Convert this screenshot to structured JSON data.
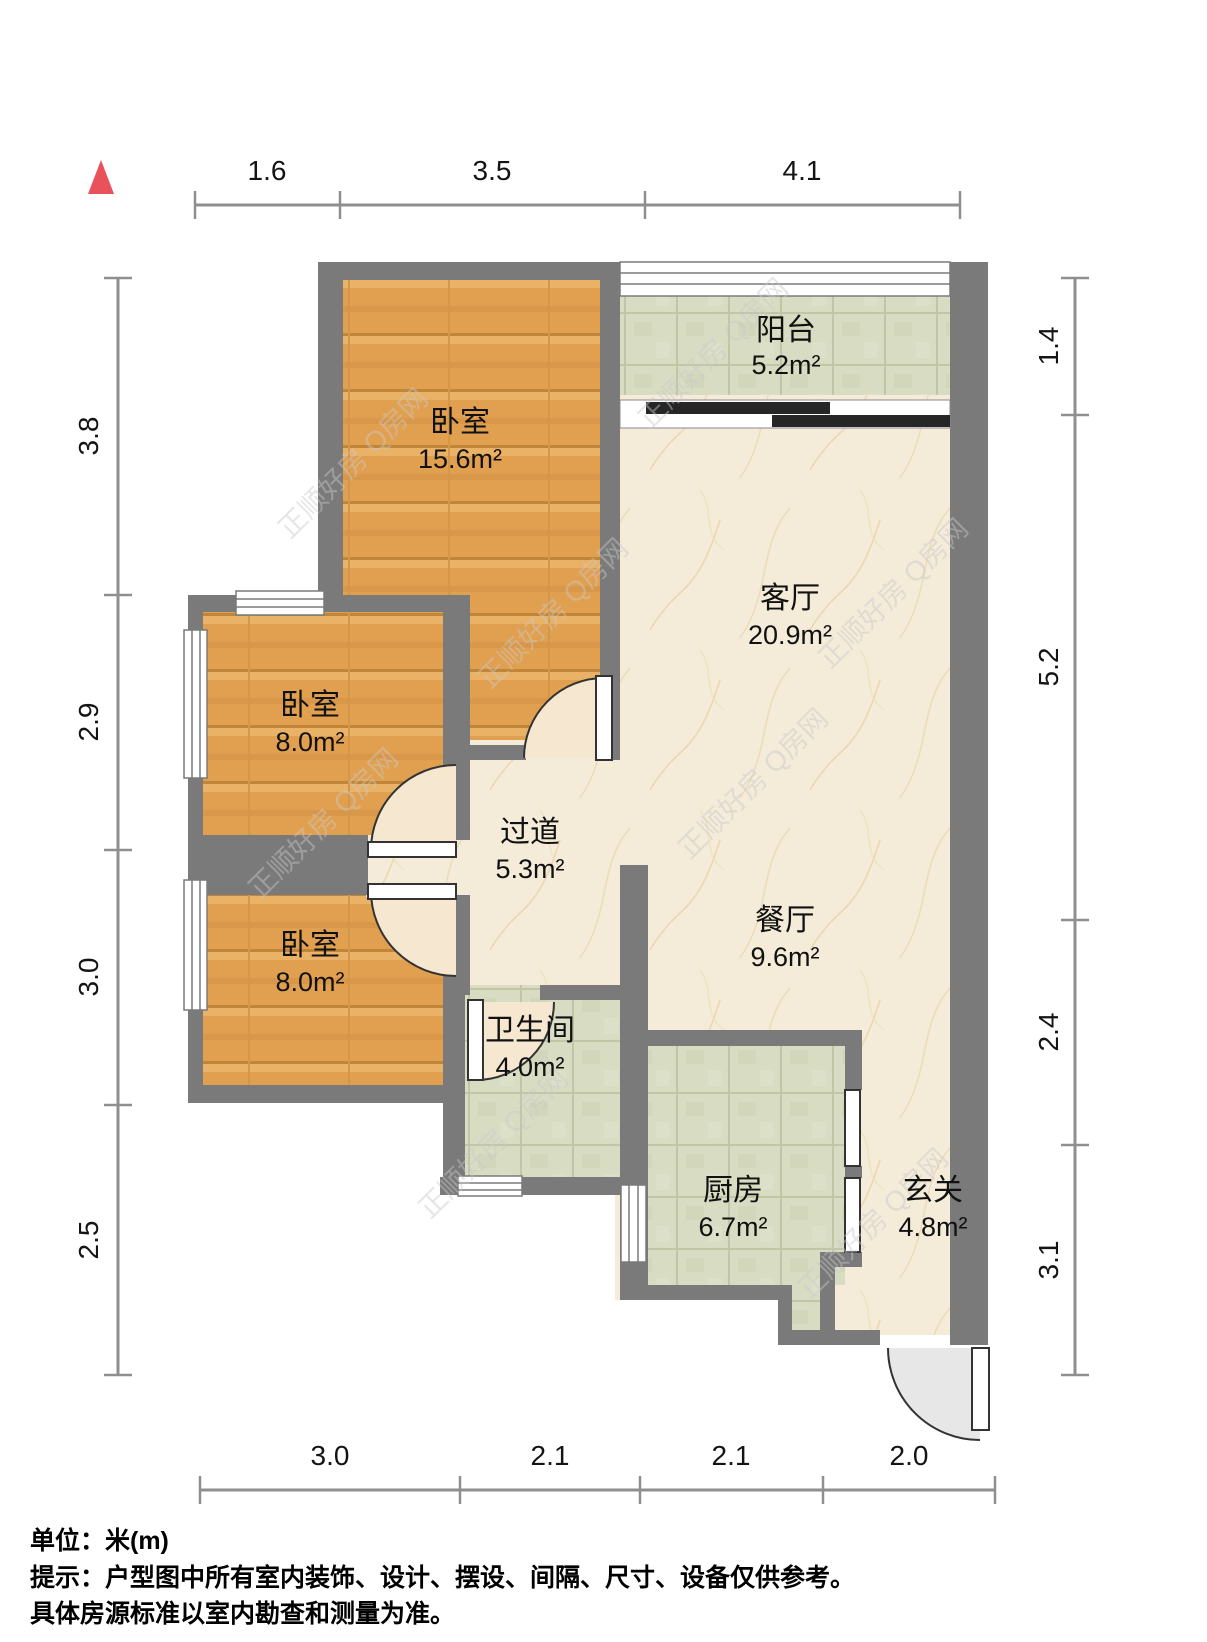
{
  "plan": {
    "unit_note": "单位：米(m)",
    "tip_line1": "提示：户型图中所有室内装饰、设计、摆设、间隔、尺寸、设备仅供参考。",
    "tip_line2": "具体房源标准以室内勘查和测量为准。",
    "watermark": "正顺好房 Q房网"
  },
  "rooms": {
    "balcony": {
      "name": "阳台",
      "area": "5.2m²"
    },
    "bedroom_top": {
      "name": "卧室",
      "area": "15.6m²"
    },
    "living": {
      "name": "客厅",
      "area": "20.9m²"
    },
    "bedroom_mid": {
      "name": "卧室",
      "area": "8.0m²"
    },
    "hallway": {
      "name": "过道",
      "area": "5.3m²"
    },
    "dining": {
      "name": "餐厅",
      "area": "9.6m²"
    },
    "bedroom_bottom": {
      "name": "卧室",
      "area": "8.0m²"
    },
    "bathroom": {
      "name": "卫生间",
      "area": "4.0m²"
    },
    "kitchen": {
      "name": "厨房",
      "area": "6.7m²"
    },
    "entry": {
      "name": "玄关",
      "area": "4.8m²"
    }
  },
  "dimensions": {
    "top": [
      "1.6",
      "3.5",
      "4.1"
    ],
    "left": [
      "3.8",
      "2.9",
      "3.0",
      "2.5"
    ],
    "right": [
      "1.4",
      "5.2",
      "2.4",
      "3.1"
    ],
    "bottom": [
      "3.0",
      "2.1",
      "2.1",
      "2.0"
    ]
  },
  "colors": {
    "wall": "#7a7a7a",
    "wood_floor": "#e19f4f",
    "tile_floor": "#d8dcc2",
    "marble_floor": "#f4ebd9",
    "north_marker": "#e9515b"
  }
}
